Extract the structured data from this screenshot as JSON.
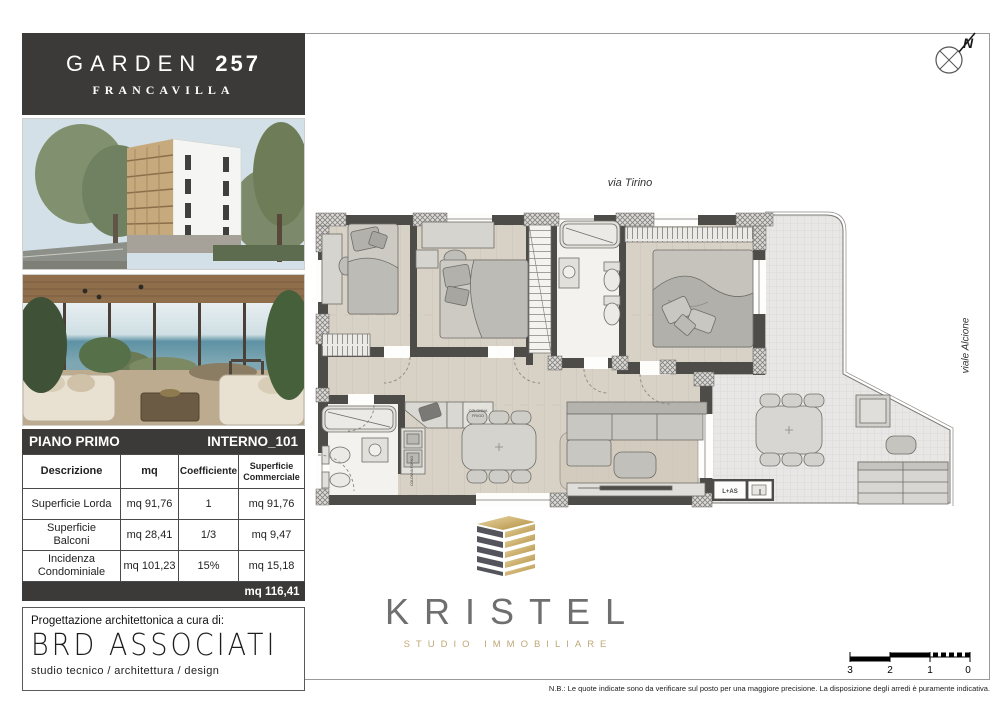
{
  "header": {
    "brand": "GARDEN",
    "number": "257",
    "city": "FRANCAVILLA"
  },
  "floor_bar": {
    "floor": "PIANO PRIMO",
    "unit": "INTERNO_101"
  },
  "table": {
    "col_desc": "Descrizione",
    "col_mq": "mq",
    "col_coef": "Coefficiente",
    "col_comm": "Superficie Commerciale",
    "rows": [
      {
        "desc": "Superficie Lorda",
        "mq": "mq 91,76",
        "coef": "1",
        "comm": "mq 91,76"
      },
      {
        "desc": "Superficie Balconi",
        "mq": "mq 28,41",
        "coef": "1/3",
        "comm": "mq 9,47"
      },
      {
        "desc": "Incidenza Condominiale",
        "mq": "mq 101,23",
        "coef": "15%",
        "comm": "mq 15,18"
      }
    ],
    "total": "mq 116,41"
  },
  "architect": {
    "intro": "Progettazione architettonica a cura di:",
    "name": "BRD ASSOCIATI",
    "tagline": "studio tecnico / architettura / design"
  },
  "streets": {
    "top": "via Tirino",
    "right": "viale Alcione"
  },
  "plan_labels": {
    "fridge_line1": "COLONNA",
    "fridge_line2": "FRIGO",
    "oven": "COLONNA FORNO",
    "laundry": "L+AS"
  },
  "compass": {
    "letter": "N"
  },
  "brand_kristel": {
    "name": "KRISTEL",
    "tagline": "STUDIO IMMOBILIARE"
  },
  "scalebar": {
    "n3": "3",
    "n2": "2",
    "n1": "1",
    "n0": "0"
  },
  "footnote": "N.B.: Le quote indicate sono da verificare sul posto per una maggiore precisione. La disposizione degli arredi è puramente indicativa.",
  "colors": {
    "header_bg": "#3b3a38",
    "wall": "#4e4c49",
    "floor": "#d8d1c6",
    "bath": "#f3f2ef",
    "terrace": "#e8e7e5",
    "gold": "#c3a565",
    "logo_gray": "#6f6f6f"
  }
}
